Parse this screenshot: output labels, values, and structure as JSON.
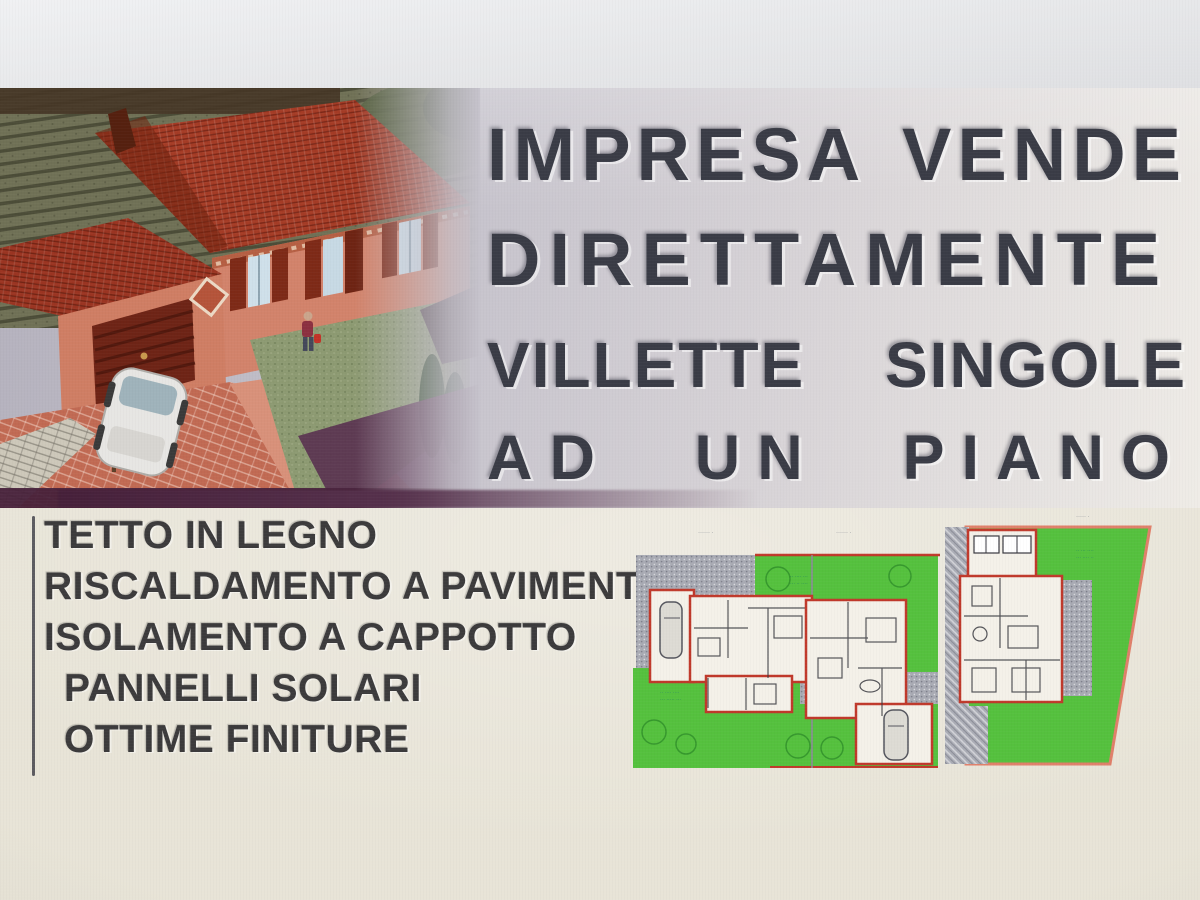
{
  "banner": {
    "headline": [
      {
        "words": [
          "IMPRESA",
          "VENDE"
        ]
      },
      {
        "words": [
          "DIRETTAMENTE"
        ]
      },
      {
        "words": [
          "VILLETTE",
          "SINGOLE"
        ]
      },
      {
        "words": [
          "AD",
          "UN",
          "PIANO"
        ]
      }
    ]
  },
  "features": {
    "items": [
      "TETTO IN LEGNO",
      "RISCALDAMENTO A PAVIMENTO",
      "ISOLAMENTO A CAPPOTTO",
      "PANNELLI SOLARI",
      "OTTIME FINITURE"
    ]
  },
  "siteplan": {
    "lot_labels": [
      "······ ·",
      "······ ·",
      "····· ·"
    ],
    "annotations": [
      "·· ···· ····",
      "··· ····· ···",
      "·· ···· ···",
      "··· ·· ····",
      "·· ··· ····",
      "··· ···· ··"
    ]
  },
  "colors": {
    "headline_text": "#3a3c46",
    "banner_gray": "#c6c3cc",
    "page_cream": "#e8e4d7",
    "plan_green": "#55c13e",
    "plan_wall_red": "#c23a23",
    "plan_paving_gray": "#a9abb4",
    "roof_red": "#a53c26",
    "wall_salmon": "#d2836b",
    "shadow_maroon": "#46203a"
  }
}
